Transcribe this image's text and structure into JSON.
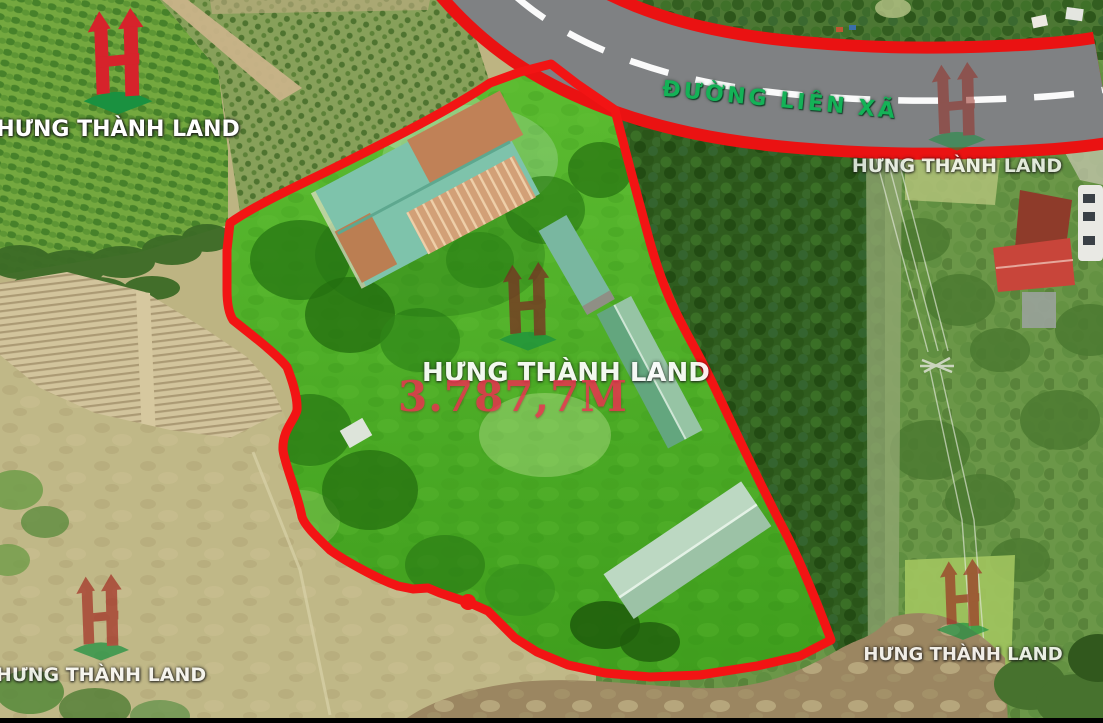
{
  "brand": {
    "name": "HƯNG THÀNH LAND"
  },
  "road": {
    "label": "ĐƯỜNG LIÊN XÃ"
  },
  "parcel": {
    "area_label": "3.787,7M"
  },
  "colors": {
    "boundary_red": "#f21414",
    "road_edge_red": "#ea1212",
    "road_gray": "#7f8183",
    "road_dash_white": "#ffffff",
    "road_label_green": "#14b257",
    "area_label_red": "#ee2e50",
    "logo_red": "#d6232b",
    "logo_watermark_red": "#8c2d27",
    "logo_green": "#1a9140",
    "parcel_green": "#4fae27"
  }
}
